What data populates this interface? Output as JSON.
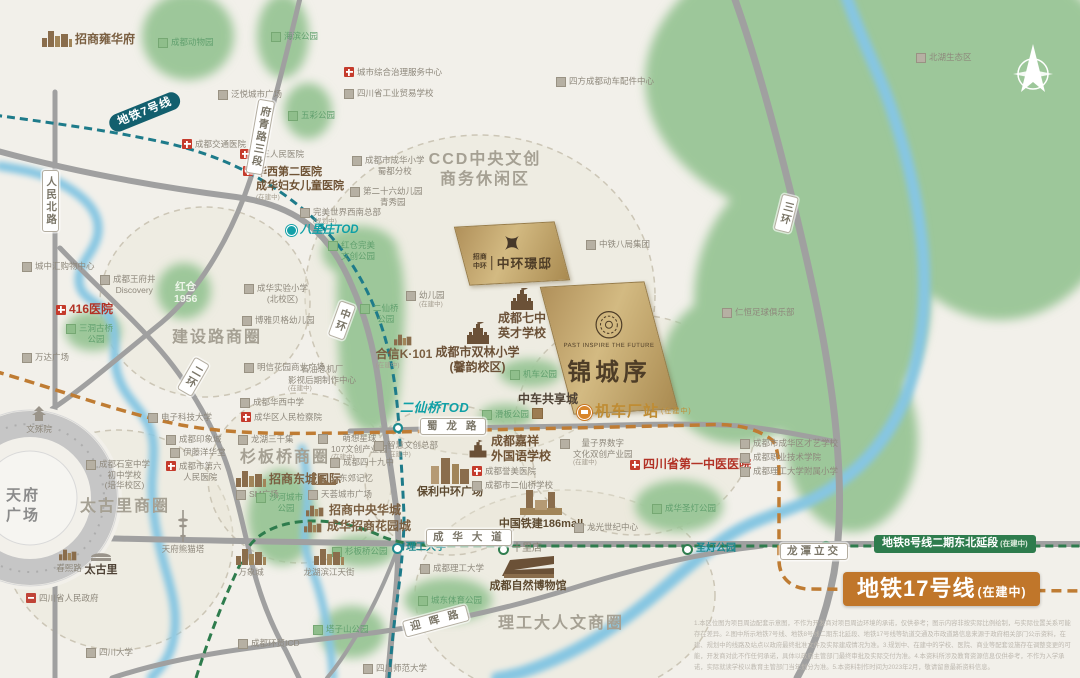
{
  "map": {
    "compass": "北",
    "tianfu_square": "天府\n广场",
    "project": {
      "en": "PAST INSPIRE THE FUTURE",
      "title": "锦城序"
    },
    "sister_project": {
      "brand": "招商中环",
      "title": "中环璟邸"
    },
    "disclaimer": "1.本区位图为项目周边配套示意图，不作为开发商对项目周边环境的承诺，仅供参考；图示内容非按实际比例绘制，与实际位置关系可能存在差异。2.图中所示地铁7号线、地铁8号线二期东北延段、地铁17号线等轨道交通及市政道路信息来源于政府相关部门公示资料，在建、规划中的线路及站点以政府最终批准文件及实际建成情况为准。3.规划中、在建中的学校、医院、商业等配套设施存在调整变更的可能，开发商对此不作任何承诺，具体以政府主管部门最终审批及实际交付为准。4.本资料所涉及教育资源信息仅供参考，不作为入学承诺，实际就读学校以教育主管部门当年划分为准。5.本资料制作时间为2023年2月，敬请留意最新资料信息。"
  },
  "colors": {
    "background": "#f2f0ea",
    "park_green": "#9dc79a",
    "river_blue": "#86c6e2",
    "road_gray": "#a0a0a0",
    "metro7_teal": "#1e7b8a",
    "metro8_green": "#2e7c4d",
    "metro17_orange": "#c0762a",
    "brand_gold": "#c9ad74",
    "hospital_red": "#c53b2c",
    "brand_brown": "#7a5f41"
  },
  "labels": [
    {
      "name": "zhaoshang-yonghuafu",
      "text": "招商雍华府",
      "x": 42,
      "y": 31,
      "cls": "brand",
      "icon": "skyline"
    },
    {
      "name": "chengdu-zoo",
      "text": "成都动物园",
      "x": 158,
      "y": 37,
      "cls": "park",
      "icon": "sq-green"
    },
    {
      "name": "haibin-park",
      "text": "海滨公园",
      "x": 271,
      "y": 31,
      "cls": "park",
      "icon": "sq-green"
    },
    {
      "name": "fanyue-plaza",
      "text": "泛悦城市广场",
      "x": 218,
      "y": 89,
      "cls": "poi",
      "icon": "sq-gray"
    },
    {
      "name": "city-governance-center",
      "text": "城市综合治理服务中心",
      "x": 344,
      "y": 67,
      "cls": "poi",
      "icon": "cross"
    },
    {
      "name": "industry-trade-school",
      "text": "四川省工业贸易学校",
      "x": 344,
      "y": 88,
      "cls": "poi",
      "icon": "sq-gray"
    },
    {
      "name": "sifang-parts-center",
      "text": "四方成都动车配件中心",
      "x": 556,
      "y": 76,
      "cls": "poi",
      "icon": "sq-gray"
    },
    {
      "name": "beihu-eco-zone",
      "text": "北湖生态区",
      "x": 916,
      "y": 52,
      "cls": "poi",
      "icon": "sq-gray"
    },
    {
      "name": "wucai-park",
      "text": "五彩公园",
      "x": 288,
      "y": 110,
      "cls": "park",
      "icon": "sq-green"
    },
    {
      "name": "jiaotong-hospital",
      "text": "成都交通医院",
      "x": 182,
      "y": 139,
      "cls": "poi",
      "icon": "cross"
    },
    {
      "name": "third-people-hospital",
      "text": "第三人民医院",
      "x": 240,
      "y": 149,
      "cls": "poi",
      "icon": "cross"
    },
    {
      "name": "huaxi-second-hospital",
      "text": "华西第二医院\n成华妇女儿童医院",
      "sub": "(在建中)",
      "x": 243,
      "y": 166,
      "cls": "brand-lg",
      "icon": "cross"
    },
    {
      "name": "chenghua-primary",
      "text": "成都市成华小学\n蜀都分校",
      "x": 352,
      "y": 155,
      "cls": "poi-c",
      "icon": "sq-gray"
    },
    {
      "name": "kindergarten-26",
      "text": "第二十六幼儿园\n青秀园",
      "x": 350,
      "y": 186,
      "cls": "poi-c",
      "icon": "sq-gray"
    },
    {
      "name": "perfect-world-hq",
      "text": "完美世界西南总部",
      "sub": "(规划中)",
      "x": 300,
      "y": 207,
      "cls": "poi",
      "icon": "sq-gray"
    },
    {
      "name": "ccd-district",
      "text": "CCD中央文创\n商务休闲区",
      "x": 420,
      "y": 150,
      "w": 130,
      "cls": "district-c"
    },
    {
      "name": "zhongtie-8ju",
      "text": "中铁八局集团",
      "x": 586,
      "y": 239,
      "cls": "poi",
      "icon": "sq-gray"
    },
    {
      "name": "renheng-football-club",
      "text": "仁恒足球俱乐部",
      "x": 722,
      "y": 307,
      "cls": "poi",
      "icon": "sq-gray"
    },
    {
      "name": "kindergarten-new",
      "text": "幼儿园",
      "sub": "(在建中)",
      "x": 406,
      "y": 290,
      "cls": "poi",
      "icon": "sq-gray"
    },
    {
      "name": "qizhong-school",
      "text": "成都七中\n英才学校",
      "x": 486,
      "y": 288,
      "w": 72,
      "cls": "school",
      "icon": "school"
    },
    {
      "name": "shuanglin-primary",
      "text": "成都市双林小学\n(馨韵校区)",
      "x": 420,
      "y": 322,
      "w": 115,
      "cls": "school",
      "icon": "school"
    },
    {
      "name": "hexin-k101",
      "text": "合信K·101",
      "sub": "(在建中)",
      "x": 366,
      "y": 334,
      "w": 76,
      "cls": "brand-c",
      "icon": "skyline-sm"
    },
    {
      "name": "shiyou-factory",
      "text": "石油总机厂\n影视后期制作中心",
      "sub": "(在建中)",
      "x": 288,
      "y": 364,
      "cls": "poi-c"
    },
    {
      "name": "jiche-park",
      "text": "机车公园",
      "x": 510,
      "y": 369,
      "cls": "park",
      "icon": "sq-green"
    },
    {
      "name": "huaban-park",
      "text": "滑板公园",
      "x": 482,
      "y": 409,
      "cls": "park",
      "icon": "sq-green"
    },
    {
      "name": "erxianqiao-park",
      "text": "二仙桥\n公园",
      "x": 360,
      "y": 303,
      "cls": "park-c",
      "icon": "sq-green"
    },
    {
      "name": "hongcang-perfect-park",
      "text": "红仓完美\n文创公园",
      "x": 328,
      "y": 240,
      "cls": "park-c",
      "icon": "sq-green"
    },
    {
      "name": "hongcang-1956",
      "text": "红仓\n1956",
      "x": 174,
      "y": 281,
      "cls": "white-park"
    },
    {
      "name": "sandong-bridge-park",
      "text": "三洞古桥\n公园",
      "x": 66,
      "y": 323,
      "cls": "park-c",
      "icon": "sq-green"
    },
    {
      "name": "hospital-416",
      "text": "416医院",
      "x": 56,
      "y": 302,
      "cls": "hosp",
      "icon": "cross"
    },
    {
      "name": "wangfujing-discovery",
      "text": "成都王府井\nDiscovery",
      "x": 100,
      "y": 274,
      "cls": "poi-c",
      "icon": "sq-gray"
    },
    {
      "name": "chengzhonghui-mall",
      "text": "城中汇购物中心",
      "x": 22,
      "y": 261,
      "cls": "poi",
      "icon": "sq-gray"
    },
    {
      "name": "wanda-plaza",
      "text": "万达广场",
      "x": 22,
      "y": 352,
      "cls": "poi",
      "icon": "sq-gray"
    },
    {
      "name": "jianshelu-district",
      "text": "建设路商圈",
      "x": 172,
      "y": 328,
      "cls": "district"
    },
    {
      "name": "chenghua-exp-primary",
      "text": "成华实验小学\n(北校区)",
      "x": 244,
      "y": 283,
      "cls": "poi-c",
      "icon": "sq-gray"
    },
    {
      "name": "boya-kindergarten",
      "text": "博雅贝格幼儿园",
      "x": 242,
      "y": 315,
      "cls": "poi",
      "icon": "sq-gray"
    },
    {
      "name": "mingxin-plaza",
      "text": "明信花园商业广场",
      "x": 244,
      "y": 362,
      "cls": "poi",
      "icon": "sq-gray"
    },
    {
      "name": "uestc",
      "text": "电子科技大学",
      "x": 148,
      "y": 412,
      "cls": "poi",
      "icon": "sq-gray"
    },
    {
      "name": "yinxiangcheng",
      "text": "成都印象城",
      "x": 166,
      "y": 434,
      "cls": "poi",
      "icon": "sq-gray"
    },
    {
      "name": "huaxi-middle-school",
      "text": "成都华西中学",
      "x": 240,
      "y": 397,
      "cls": "poi",
      "icon": "sq-gray"
    },
    {
      "name": "procuratorate",
      "text": "成华区人民检察院",
      "x": 241,
      "y": 412,
      "cls": "poi",
      "icon": "cross"
    },
    {
      "name": "longhu-3000",
      "text": "龙湖三千集",
      "x": 238,
      "y": 434,
      "cls": "poi",
      "icon": "sq-gray"
    },
    {
      "name": "mengxiang-107",
      "text": "萌想星球\n107文创产业园",
      "sub": "(在建中)",
      "x": 318,
      "y": 433,
      "cls": "poi-c",
      "icon": "sq-gray"
    },
    {
      "name": "chengdu-49-school",
      "text": "成都四十九中",
      "x": 330,
      "y": 457,
      "cls": "poi",
      "icon": "sq-gray"
    },
    {
      "name": "shanbanqiao-district",
      "text": "杉板桥商圈",
      "x": 240,
      "y": 448,
      "cls": "district"
    },
    {
      "name": "dongcheng-intl",
      "text": "招商东城国际",
      "x": 236,
      "y": 471,
      "cls": "brand",
      "icon": "skyline"
    },
    {
      "name": "dongjiao-memory",
      "text": "东郊记忆",
      "x": 310,
      "y": 473,
      "cls": "poi",
      "icon": "factory"
    },
    {
      "name": "sm-plaza",
      "text": "SM广场",
      "x": 236,
      "y": 489,
      "cls": "poi",
      "icon": "sq-gray"
    },
    {
      "name": "tianhui-plaza",
      "text": "天荟城市广场",
      "x": 308,
      "y": 489,
      "cls": "poi",
      "icon": "sq-gray"
    },
    {
      "name": "zs-zhongyang-huacheng",
      "text": "招商中央华城",
      "x": 306,
      "y": 503,
      "cls": "brand",
      "icon": "skyline-sm"
    },
    {
      "name": "ch-zs-huayuancheng",
      "text": "成华招商花园城",
      "x": 304,
      "y": 519,
      "cls": "brand",
      "icon": "skyline-sm"
    },
    {
      "name": "shahe-city-park",
      "text": "沙河城市\n公园",
      "x": 256,
      "y": 492,
      "cls": "park-c",
      "icon": "sq-green"
    },
    {
      "name": "shanbanqiao-park",
      "text": "杉板桥公园",
      "x": 332,
      "y": 546,
      "cls": "park",
      "icon": "sq-green"
    },
    {
      "name": "wenshu-monastery",
      "text": "文殊院",
      "x": 16,
      "y": 406,
      "w": 46,
      "cls": "poi-ab",
      "icon": "temple"
    },
    {
      "name": "shishi-middle",
      "text": "成都石室中学\n初中学校\n(培华校区)",
      "x": 86,
      "y": 459,
      "cls": "poi-c",
      "icon": "sq-gray"
    },
    {
      "name": "sixth-people-hospital",
      "text": "成都市第六\n人民医院",
      "x": 166,
      "y": 461,
      "cls": "poi-c",
      "icon": "cross"
    },
    {
      "name": "ito-yokado",
      "text": "伊藤洋华堂",
      "x": 170,
      "y": 447,
      "cls": "poi",
      "icon": "sq-gray"
    },
    {
      "name": "taikooli-district",
      "text": "太古里商圈",
      "x": 80,
      "y": 497,
      "cls": "district"
    },
    {
      "name": "panda-tower",
      "text": "天府熊猫塔",
      "x": 148,
      "y": 510,
      "w": 70,
      "cls": "poi-ab",
      "icon": "tower"
    },
    {
      "name": "chunxi-road",
      "text": "春熙路",
      "x": 48,
      "y": 549,
      "w": 42,
      "cls": "poi-ab",
      "icon": "skyline-sm"
    },
    {
      "name": "taikooli",
      "text": "太古里",
      "x": 78,
      "y": 549,
      "w": 46,
      "cls": "dark-ab",
      "icon": "pavilion"
    },
    {
      "name": "provincial-gov",
      "text": "四川省人民政府",
      "x": 26,
      "y": 593,
      "cls": "poi",
      "icon": "gov"
    },
    {
      "name": "sichuan-univ",
      "text": "四川大学",
      "x": 86,
      "y": 647,
      "cls": "poi",
      "icon": "sq-gray"
    },
    {
      "name": "wanxiangcheng",
      "text": "万象城",
      "x": 228,
      "y": 549,
      "w": 46,
      "cls": "poi-ab",
      "icon": "skyline"
    },
    {
      "name": "longhu-binjiang",
      "text": "龙湖滨江天街",
      "x": 295,
      "y": 549,
      "w": 68,
      "cls": "poi-ab",
      "icon": "skyline"
    },
    {
      "name": "chengdu-icd",
      "text": "成都环贸ICD",
      "x": 238,
      "y": 638,
      "cls": "poi",
      "icon": "sq-gray"
    },
    {
      "name": "tazishan-park",
      "text": "塔子山公园",
      "x": 313,
      "y": 624,
      "cls": "park",
      "icon": "sq-green"
    },
    {
      "name": "sichuan-normal-univ",
      "text": "四川师范大学",
      "x": 363,
      "y": 663,
      "cls": "poi",
      "icon": "sq-gray"
    },
    {
      "name": "ligong-district",
      "text": "理工大人文商圈",
      "x": 498,
      "y": 614,
      "cls": "district"
    },
    {
      "name": "nature-museum",
      "text": "成都自然博物馆",
      "x": 478,
      "y": 554,
      "w": 100,
      "cls": "brand-ab",
      "icon": "museum"
    },
    {
      "name": "chengdu-ligong-univ",
      "text": "成都理工大学",
      "x": 420,
      "y": 563,
      "cls": "poi",
      "icon": "sq-gray"
    },
    {
      "name": "chengdong-sport-park",
      "text": "城东体育公园",
      "x": 418,
      "y": 595,
      "cls": "park",
      "icon": "sq-green"
    },
    {
      "name": "baoli-zhonghuan",
      "text": "保利中环广场",
      "x": 402,
      "y": 456,
      "w": 96,
      "cls": "brand-ab",
      "icon": "skyline-lg"
    },
    {
      "name": "jiaxiang-school",
      "text": "成都嘉祥\n外国语学校",
      "x": 468,
      "y": 434,
      "cls": "brand-row",
      "icon": "school-sm"
    },
    {
      "name": "yumei-hospital",
      "text": "成都誉美医院",
      "x": 472,
      "y": 466,
      "cls": "poi",
      "icon": "cross"
    },
    {
      "name": "erxianqiao-school",
      "text": "成都市二仙桥学校",
      "x": 472,
      "y": 480,
      "cls": "poi",
      "icon": "sq-gray"
    },
    {
      "name": "zhihui-hq",
      "text": "智慧文创总部",
      "sub": "(在建中)",
      "x": 374,
      "y": 440,
      "cls": "poi",
      "icon": "sq-gray"
    },
    {
      "name": "liangzijie",
      "text": "量子界数字\n文化双创产业园",
      "sub": "(在建中)",
      "x": 560,
      "y": 438,
      "cls": "poi-c",
      "icon": "sq-gray"
    },
    {
      "name": "first-tcm-hospital",
      "text": "四川省第一中医医院",
      "x": 630,
      "y": 457,
      "cls": "hosp",
      "icon": "cross"
    },
    {
      "name": "caiyi-school",
      "text": "成都市成华区才艺学校",
      "x": 740,
      "y": 438,
      "cls": "poi",
      "icon": "sq-gray"
    },
    {
      "name": "vocational-college",
      "text": "成都职业技术学院",
      "x": 740,
      "y": 452,
      "cls": "poi",
      "icon": "sq-gray"
    },
    {
      "name": "ligong-primary",
      "text": "成都理工大学附属小学",
      "x": 740,
      "y": 466,
      "cls": "poi",
      "icon": "sq-gray"
    },
    {
      "name": "chenghua-shengdeng-park",
      "text": "成华圣灯公园",
      "x": 652,
      "y": 503,
      "cls": "park",
      "icon": "sq-green"
    },
    {
      "name": "tiejian-186mall",
      "text": "中国铁建186mall",
      "x": 486,
      "y": 488,
      "w": 110,
      "cls": "brand-ab",
      "icon": "mall"
    },
    {
      "name": "longguang-center",
      "text": "龙光世纪中心",
      "x": 574,
      "y": 522,
      "cls": "poi",
      "icon": "sq-gray"
    },
    {
      "name": "zhongche-city",
      "text": "中车共享城",
      "x": 518,
      "y": 392,
      "cls": "dark"
    },
    {
      "name": "zhongche-marker",
      "text": "",
      "x": 532,
      "y": 408,
      "cls": "icon-only",
      "icon": "sq-brown"
    },
    {
      "name": "jichechang-station",
      "text": "机车厂站",
      "sub": "(在建中)",
      "x": 577,
      "y": 403,
      "cls": "gold-st",
      "icon": "dot-train"
    },
    {
      "name": "station-ligong-univ",
      "text": "理工大学",
      "x": 392,
      "y": 542,
      "cls": "station-t",
      "icon": "dot-teal"
    },
    {
      "name": "station-shilidian",
      "text": "十里店",
      "x": 498,
      "y": 543,
      "cls": "station-g",
      "icon": "dot-green"
    },
    {
      "name": "station-shengdeng",
      "text": "圣灯公园",
      "x": 682,
      "y": 543,
      "cls": "station-t",
      "icon": "dot-green"
    },
    {
      "name": "longtan-interchange",
      "text": "龙潭立交",
      "x": 780,
      "y": 543,
      "cls": "roadbox"
    },
    {
      "name": "metro8-badge",
      "text": "地铁8号线二期东北延段",
      "sub": "(在建中)",
      "x": 874,
      "y": 535,
      "cls": "badge8"
    },
    {
      "name": "metro17-badge",
      "text": "地铁17号线",
      "sub": "(在建中)",
      "x": 843,
      "y": 572,
      "cls": "badge17"
    },
    {
      "name": "metro7-badge",
      "text": "地铁7号线",
      "x": 110,
      "y": 117,
      "cls": "badge7",
      "rot": -22
    },
    {
      "name": "tod-balizhuang",
      "text": "八里庄TOD",
      "x": 286,
      "y": 223,
      "cls": "tod-sm",
      "icon": "dot-teal2"
    },
    {
      "name": "tod-erxianqiao",
      "text": "二仙桥TOD",
      "x": 400,
      "y": 400,
      "cls": "tod"
    },
    {
      "name": "road-renmin-north",
      "text": "人民北路",
      "x": 42,
      "y": 170,
      "cls": "roadbox-v"
    },
    {
      "name": "road-fuqing-3",
      "text": "府青路三段",
      "x": 252,
      "y": 98,
      "cls": "roadbox-v",
      "rot": 10
    },
    {
      "name": "road-sanhuan",
      "text": "三环",
      "x": 778,
      "y": 193,
      "cls": "roadbox-v",
      "rot": 14
    },
    {
      "name": "road-zhonghuan",
      "text": "中环",
      "x": 334,
      "y": 299,
      "cls": "roadbox-v",
      "rot": 20
    },
    {
      "name": "road-erhuan",
      "text": "二环",
      "x": 186,
      "y": 354,
      "cls": "roadbox-v",
      "rot": 30
    },
    {
      "name": "road-shulong",
      "text": "蜀 龙 路",
      "x": 420,
      "y": 418,
      "cls": "roadbox"
    },
    {
      "name": "road-chenghua-ave",
      "text": "成 华 大 道",
      "x": 426,
      "y": 529,
      "cls": "roadbox"
    },
    {
      "name": "road-yinghui",
      "text": "迎 晖 路",
      "x": 404,
      "y": 621,
      "cls": "roadbox",
      "rot": -15
    },
    {
      "name": "tianfu-square-label",
      "text": "天府\n广场",
      "x": 6,
      "y": 486,
      "cls": "tianfu-txt"
    }
  ]
}
